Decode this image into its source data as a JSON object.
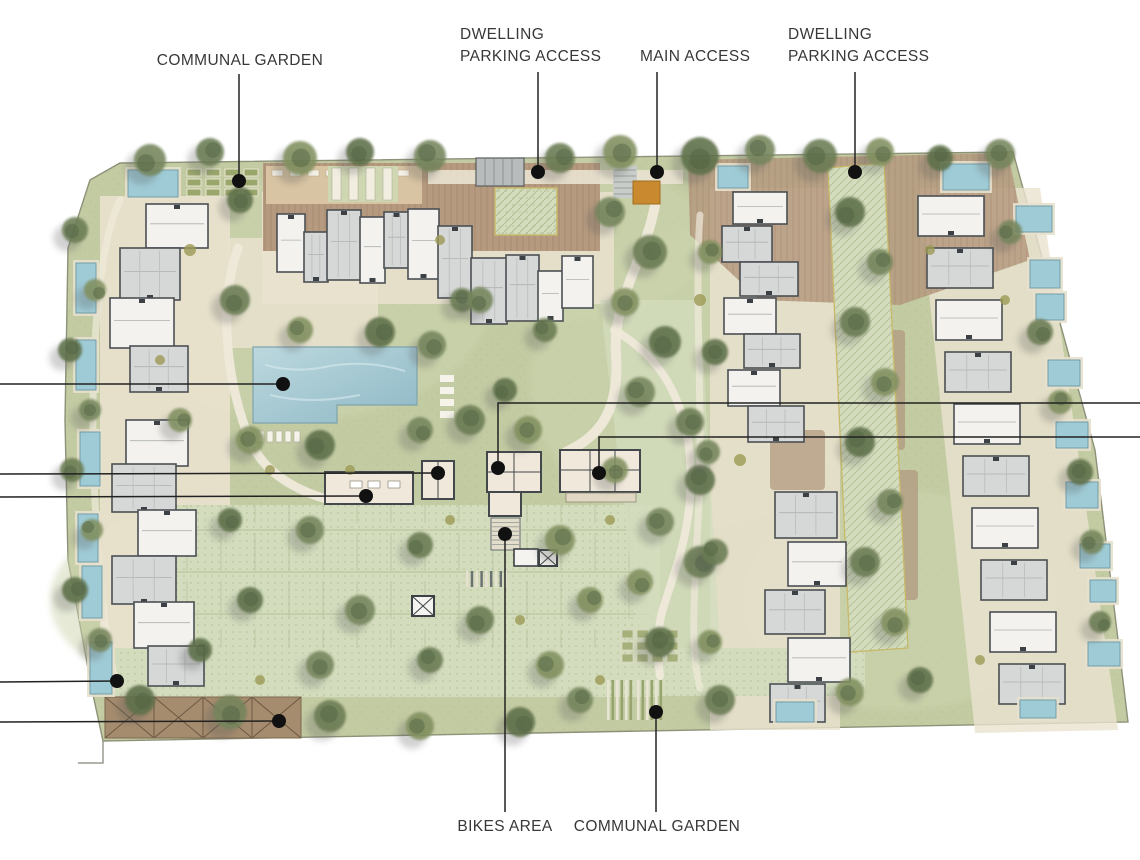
{
  "meta": {
    "type": "architectural-site-plan",
    "description": "Residential development masterplan with dwellings, communal gardens, pool, parking and access points"
  },
  "palette": {
    "paper": "#ffffff",
    "grass": "#c3cba3",
    "grass_light": "#cdd5af",
    "paving": "#d3dcbd",
    "terrace": "#eae2cf",
    "deck_brown": "#b59a7f",
    "pergola_brown": "#a68c6e",
    "building_white": "#f3f2ee",
    "building_gray": "#d6d8d7",
    "building_outline": "#4b5054",
    "amenity_fill": "#f0e9db",
    "pool_blue_light": "#bcd8de",
    "pool_blue": "#93bcc8",
    "private_pool": "#9fcbd6",
    "accent_orange": "#c9892f",
    "hatch_border": "#c8b96a",
    "leader": "#222222",
    "dot": "#111111",
    "label_text": "#383838"
  },
  "annotations": {
    "labeled": [
      {
        "id": "communal-garden-top",
        "text": "COMMUNAL GARDEN",
        "align": "center",
        "tx": 240,
        "ty": 50,
        "leader": [
          [
            239,
            74
          ],
          [
            239,
            181
          ]
        ],
        "dot": [
          239,
          181
        ]
      },
      {
        "id": "dwelling-parking-access-left",
        "text": "DWELLING\nPARKING ACCESS",
        "align": "left",
        "tx": 460,
        "ty": 24,
        "leader": [
          [
            538,
            72
          ],
          [
            538,
            172
          ]
        ],
        "dot": [
          538,
          172
        ]
      },
      {
        "id": "main-access",
        "text": "MAIN ACCESS",
        "align": "left",
        "tx": 640,
        "ty": 46,
        "leader": [
          [
            657,
            72
          ],
          [
            657,
            172
          ]
        ],
        "dot": [
          657,
          172
        ]
      },
      {
        "id": "dwelling-parking-access-right",
        "text": "DWELLING\nPARKING ACCESS",
        "align": "left",
        "tx": 788,
        "ty": 24,
        "leader": [
          [
            855,
            72
          ],
          [
            855,
            172
          ]
        ],
        "dot": [
          855,
          172
        ]
      },
      {
        "id": "bikes-area",
        "text": "BIKES AREA",
        "align": "center",
        "tx": 505,
        "ty": 816,
        "leader": [
          [
            505,
            812
          ],
          [
            505,
            534
          ]
        ],
        "dot": [
          505,
          534
        ]
      },
      {
        "id": "communal-garden-bottom",
        "text": "COMMUNAL GARDEN",
        "align": "center",
        "tx": 657,
        "ty": 816,
        "leader": [
          [
            656,
            812
          ],
          [
            656,
            712
          ]
        ],
        "dot": [
          656,
          712
        ]
      }
    ],
    "unlabeled": [
      {
        "id": "callout-main-pool",
        "leader": [
          [
            0,
            384
          ],
          [
            283,
            384
          ]
        ],
        "dot": [
          283,
          384
        ]
      },
      {
        "id": "callout-amenity-a",
        "leader": [
          [
            0,
            474
          ],
          [
            438,
            473
          ]
        ],
        "dot": [
          438,
          473
        ]
      },
      {
        "id": "callout-gym",
        "leader": [
          [
            0,
            497
          ],
          [
            366,
            496
          ]
        ],
        "dot": [
          366,
          496
        ]
      },
      {
        "id": "callout-footpath",
        "leader": [
          [
            0,
            682
          ],
          [
            117,
            681
          ]
        ],
        "dot": [
          117,
          681
        ]
      },
      {
        "id": "callout-pergola",
        "leader": [
          [
            0,
            722
          ],
          [
            279,
            721
          ]
        ],
        "dot": [
          279,
          721
        ]
      },
      {
        "id": "callout-amenity-b",
        "leader": [
          [
            1140,
            403
          ],
          [
            498,
            403
          ],
          [
            498,
            468
          ]
        ],
        "dot": [
          498,
          468
        ]
      },
      {
        "id": "callout-amenity-c",
        "leader": [
          [
            1140,
            437
          ],
          [
            599,
            437
          ],
          [
            599,
            473
          ]
        ],
        "dot": [
          599,
          473
        ]
      }
    ]
  }
}
